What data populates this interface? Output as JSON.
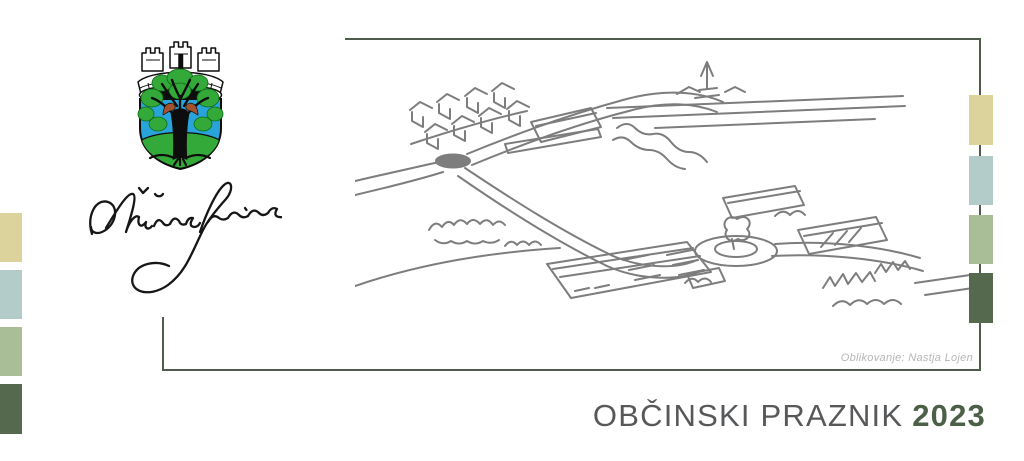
{
  "banner": {
    "title": "OBČINSKI PRAZNIK",
    "year": "2023",
    "title_color": "#57585a",
    "year_color": "#4c5f47"
  },
  "artwork": {
    "credit": "Oblikovanje: Nastja Lojen",
    "credit_color": "#b6b6b6",
    "sketch_stroke_color": "#7d7d7d",
    "frame_color": "#4f5b4c"
  },
  "municipality": {
    "signature_text": "Občina Sevnica",
    "coat_of_arms": {
      "shield_blue": "#29a4db",
      "ground_green": "#33a93a",
      "foliage_green": "#33a93a",
      "bird_brown": "#a4512e",
      "outline_black": "#0d0d0d"
    }
  },
  "palette_squares": [
    {
      "name": "tan",
      "hex": "#dcd29b"
    },
    {
      "name": "light-blue",
      "hex": "#b3ccc9"
    },
    {
      "name": "sage-green",
      "hex": "#a9bd97"
    },
    {
      "name": "dark-green",
      "hex": "#55694e"
    }
  ]
}
